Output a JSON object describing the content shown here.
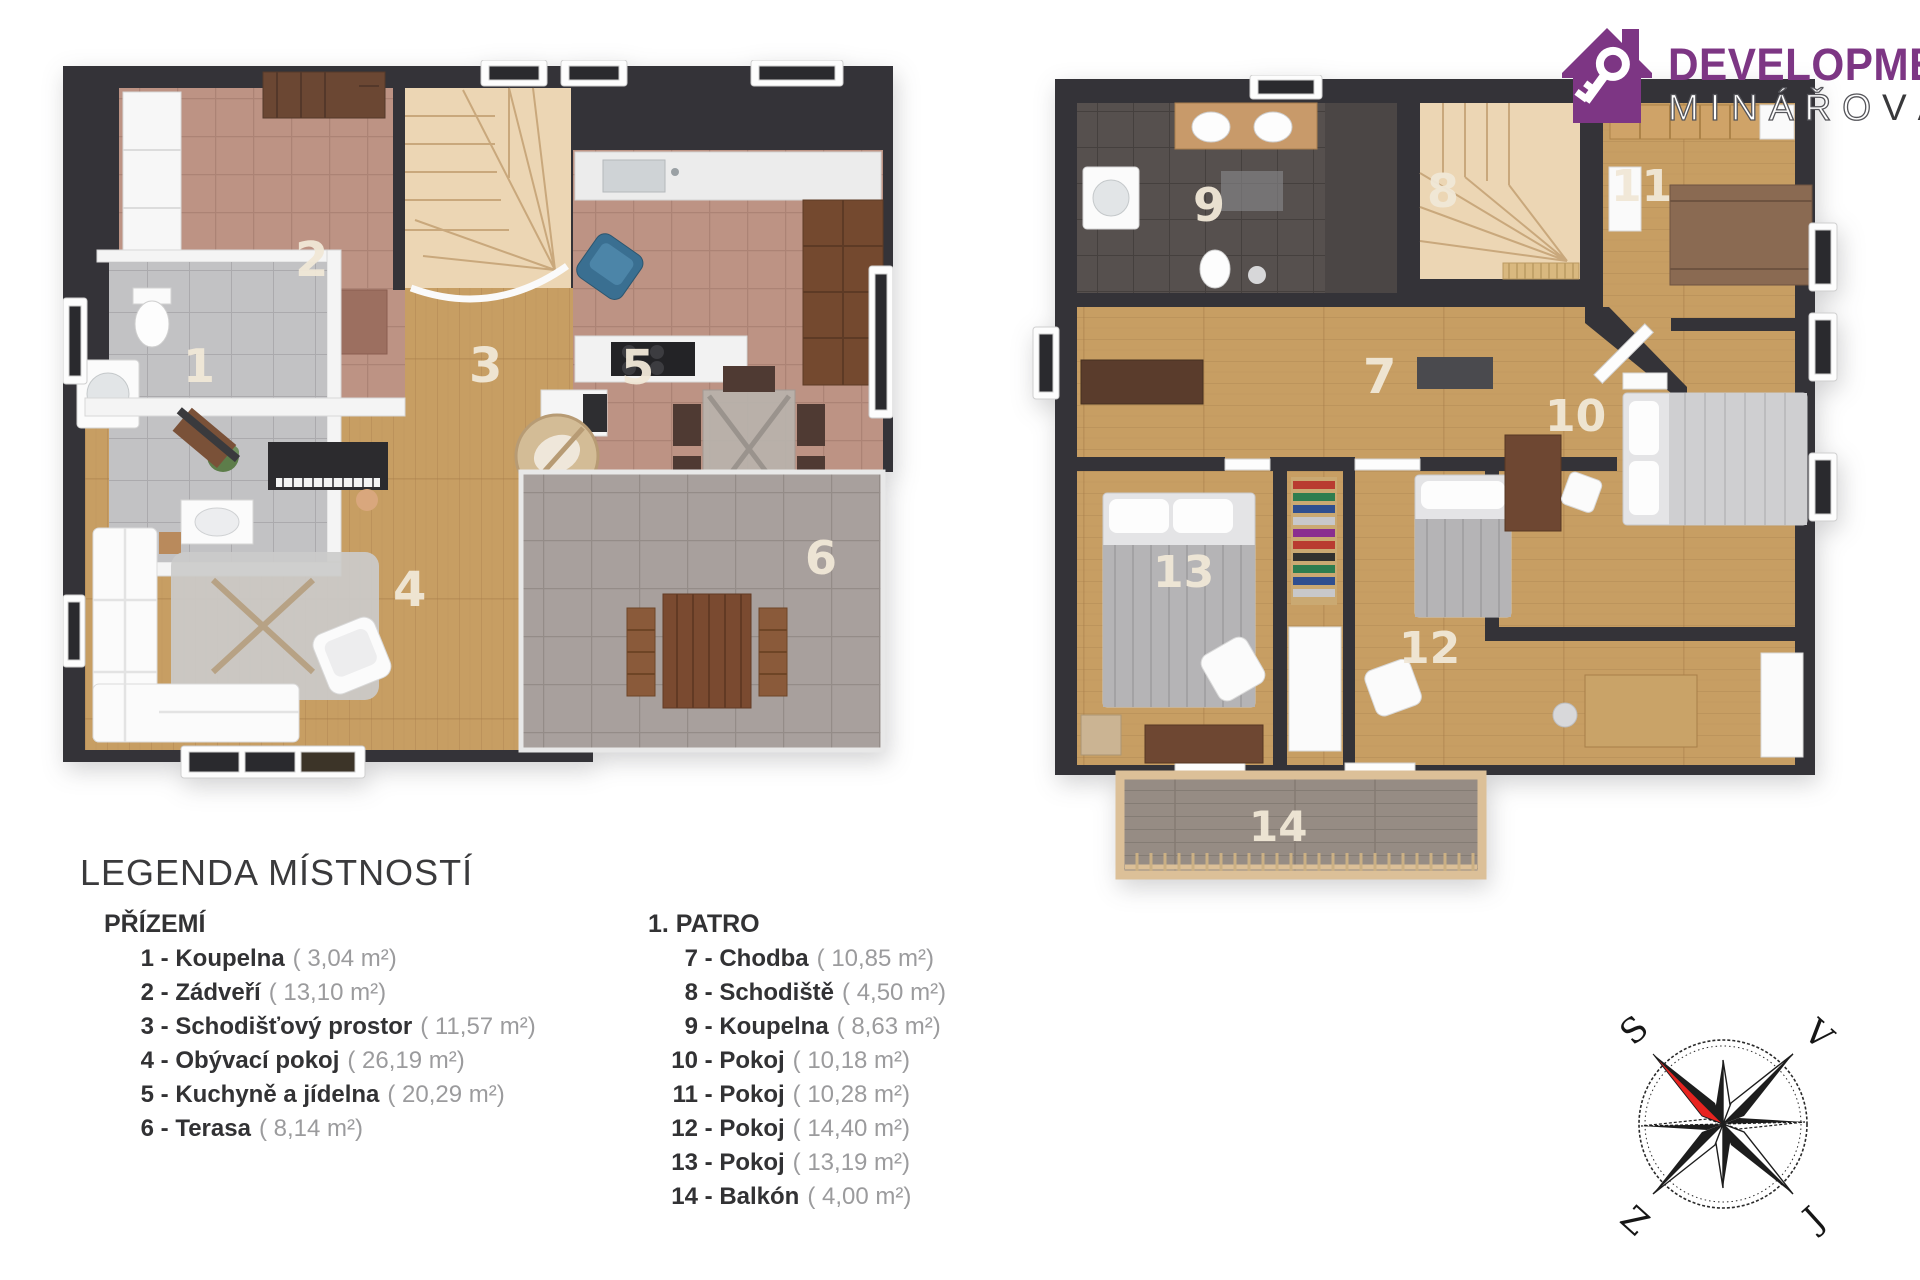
{
  "logo": {
    "brand_top": "DEVELOPMENT",
    "brand_bottom_outline": "MINÁŘO",
    "brand_bottom_solid": "VÁ"
  },
  "legend": {
    "title": "LEGENDA MÍSTNOSTÍ",
    "sep": " - ",
    "floors": [
      {
        "heading": "PŘÍZEMÍ",
        "rooms": [
          {
            "num": "1",
            "name": "Koupelna",
            "area": "( 3,04 m²)"
          },
          {
            "num": "2",
            "name": "Zádveří",
            "area": "( 13,10 m²)"
          },
          {
            "num": "3",
            "name": "Schodišťový prostor",
            "area": "( 11,57 m²)"
          },
          {
            "num": "4",
            "name": "Obývací pokoj",
            "area": "( 26,19 m²)"
          },
          {
            "num": "5",
            "name": "Kuchyně a jídelna",
            "area": "( 20,29 m²)"
          },
          {
            "num": "6",
            "name": "Terasa",
            "area": "( 8,14 m²)"
          }
        ]
      },
      {
        "heading": "1. PATRO",
        "rooms": [
          {
            "num": "7",
            "name": "Chodba",
            "area": "( 10,85 m²)"
          },
          {
            "num": "8",
            "name": "Schodiště",
            "area": "( 4,50 m²)"
          },
          {
            "num": "9",
            "name": "Koupelna",
            "area": "( 8,63 m²)"
          },
          {
            "num": "10",
            "name": "Pokoj",
            "area": "( 10,18 m²)"
          },
          {
            "num": "11",
            "name": "Pokoj",
            "area": "( 10,28 m²)"
          },
          {
            "num": "12",
            "name": "Pokoj",
            "area": "( 14,40 m²)"
          },
          {
            "num": "13",
            "name": "Pokoj",
            "area": "( 13,19 m²)"
          },
          {
            "num": "14",
            "name": "Balkón",
            "area": "( 4,00 m²)"
          }
        ]
      }
    ]
  },
  "compass": {
    "north": "S",
    "east": "V",
    "west": "Z",
    "south": "J"
  },
  "colors": {
    "wall": "#343338",
    "wood_floor": "#c79e63",
    "tile_entry_kitchen": "#bd9384",
    "tile_bath_ground": "#c2c2c4",
    "tile_bath_first": "#56504e",
    "tile_terrace": "#a8a09d",
    "balcony_deck": "#968c84",
    "stairs": "#ecd6b4",
    "brand_purple": "#7d3684",
    "compass_red": "#e8231f",
    "room_label": "#f1e8d7",
    "legend_text": "#323234",
    "legend_area_gray": "#9b9b9d"
  }
}
